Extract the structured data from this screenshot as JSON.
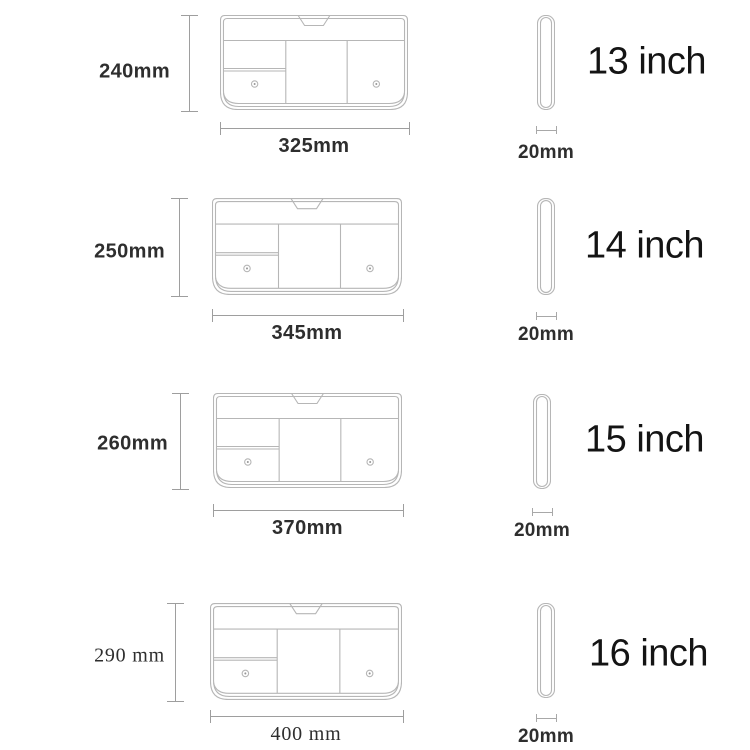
{
  "diagram": {
    "subject": "laptop-sleeve-size-chart",
    "unit": "mm",
    "colors": {
      "background": "#ffffff",
      "drawing_line": "#b6b6b6",
      "dimension_line": "#9e9e9e",
      "dimension_text": "#2e2e2e",
      "size_text": "#141414"
    }
  },
  "sizes": [
    {
      "inch_label": "13 inch",
      "height_label": "240mm",
      "width_label": "325mm",
      "depth_label": "20mm"
    },
    {
      "inch_label": "14 inch",
      "height_label": "250mm",
      "width_label": "345mm",
      "depth_label": "20mm"
    },
    {
      "inch_label": "15 inch",
      "height_label": "260mm",
      "width_label": "370mm",
      "depth_label": "20mm"
    },
    {
      "inch_label": "16 inch",
      "height_label": "290 mm",
      "width_label": "400 mm",
      "depth_label": "20mm"
    }
  ]
}
